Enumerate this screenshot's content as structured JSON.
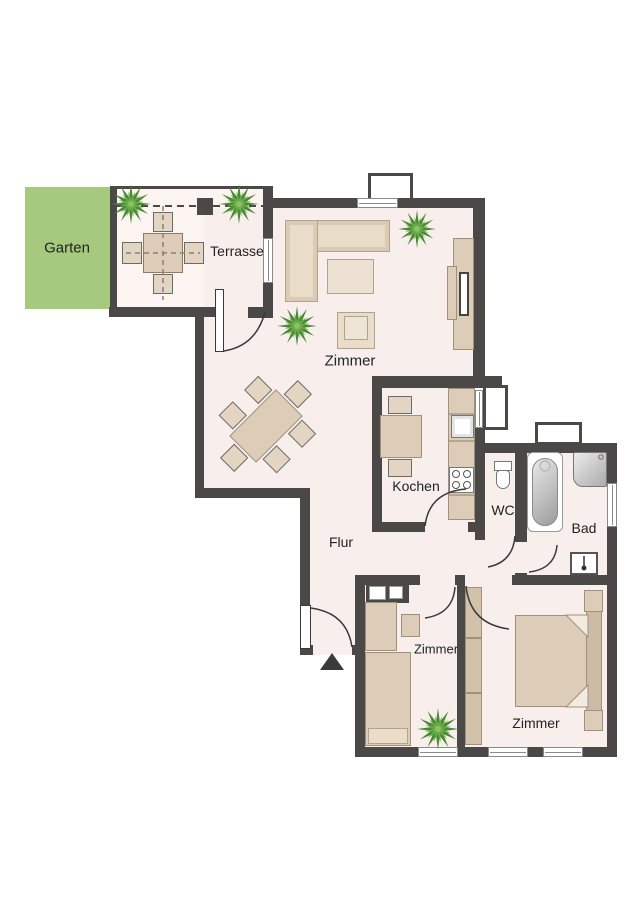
{
  "title": "Grundriss Wohnung (floor plan)",
  "rooms": {
    "garten": {
      "label": "Garten"
    },
    "terrasse": {
      "label": "Terrasse"
    },
    "wohnzimmer": {
      "label": "Zimmer"
    },
    "kochen": {
      "label": "Kochen"
    },
    "wc": {
      "label": "WC"
    },
    "bad": {
      "label": "Bad"
    },
    "flur": {
      "label": "Flur"
    },
    "zimmer_klein": {
      "label": "Zimmer"
    },
    "zimmer_gross": {
      "label": "Zimmer"
    }
  },
  "colors": {
    "wall": "#4a4947",
    "floor": "#f8efed",
    "terrace_floor": "#fbf4f1",
    "garden": "#a5ca7d",
    "furniture": "#ddccb8",
    "furniture_light": "#e9dcc9",
    "plant_dark": "#4a8a34",
    "plant_light": "#6aab4a",
    "background": "#ffffff"
  },
  "icons": {
    "entrance_arrow": "entrance-arrow",
    "plants": "potted-plant"
  }
}
